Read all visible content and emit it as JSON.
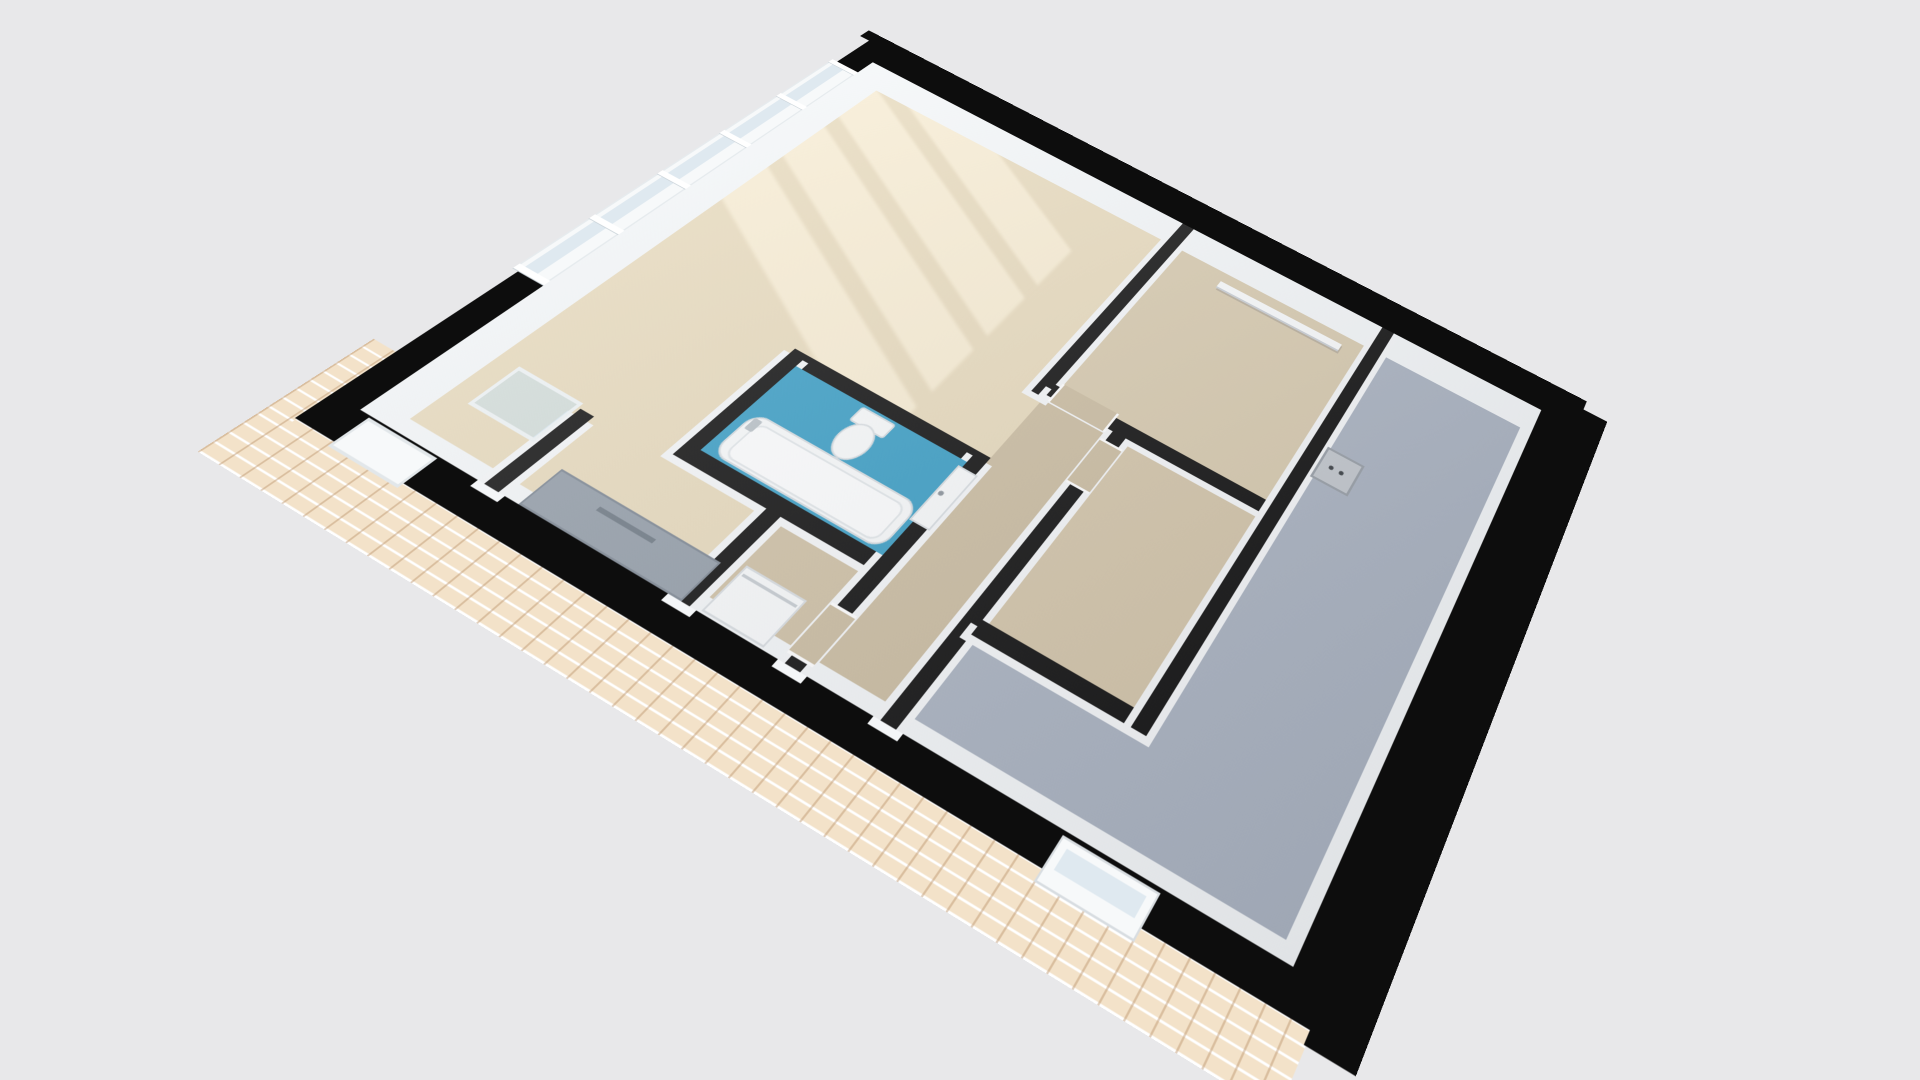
{
  "scene": {
    "kind": "3d-floor-plan-render",
    "view": "rotated isometric top-down",
    "background": "#e8e8ea",
    "has_text": false
  },
  "colors": {
    "background": "#e8e8ea",
    "wall_top": "#111111",
    "exterior_wall": "#0d0d0d",
    "wall_face_white": "#f3f6f8",
    "living_floor": "#e7dabd",
    "hall_floor": "#cbbda2",
    "room_top_right_floor": "#d7caaf",
    "room_mid_right_floor": "#d3c5aa",
    "alcove_floor": "#cfc1a6",
    "bathroom_floor": "#3b9ec5",
    "gray_room_floor": "#aab3c1",
    "sun_patch": "#faf0d7",
    "counter_gray": "#949ea9",
    "counter_edge": "#6f7a85",
    "brick": "#f3e2c9",
    "glass": "#dfe9f0",
    "fixture_white": "#f7f9fa",
    "panel_gray": "#c2c7cd"
  },
  "rooms": [
    {
      "name": "living-room",
      "floor": "living_floor",
      "features": [
        "window-wall",
        "sun-patches",
        "kitchen-counter",
        "glass-table"
      ]
    },
    {
      "name": "bathroom",
      "floor": "bathroom_floor",
      "features": [
        "toilet",
        "bathtub",
        "door"
      ]
    },
    {
      "name": "laundry-alcove",
      "floor": "alcove_floor",
      "features": [
        "washer"
      ]
    },
    {
      "name": "corridor",
      "floor": "hall_floor",
      "features": []
    },
    {
      "name": "room-top-right",
      "floor": "room_top_right_floor",
      "features": [
        "wall-rail"
      ]
    },
    {
      "name": "room-mid-right",
      "floor": "room_mid_right_floor",
      "features": []
    },
    {
      "name": "large-gray-room",
      "floor": "gray_room_floor",
      "features": [
        "utility-panel",
        "bottom-window"
      ]
    }
  ],
  "fixtures": [
    {
      "name": "toilet"
    },
    {
      "name": "bathtub"
    },
    {
      "name": "bathtub-faucet"
    },
    {
      "name": "washer"
    },
    {
      "name": "kitchen-counter"
    },
    {
      "name": "glass-table"
    },
    {
      "name": "wall-rail"
    },
    {
      "name": "utility-panel"
    },
    {
      "name": "entrance-door"
    },
    {
      "name": "bathroom-door"
    },
    {
      "name": "window-band-left"
    },
    {
      "name": "small-window-bottom"
    }
  ],
  "exterior": {
    "brick_side": "bottom-left edge",
    "black_side": "right and top edges",
    "window_count_left_wall": 5
  }
}
